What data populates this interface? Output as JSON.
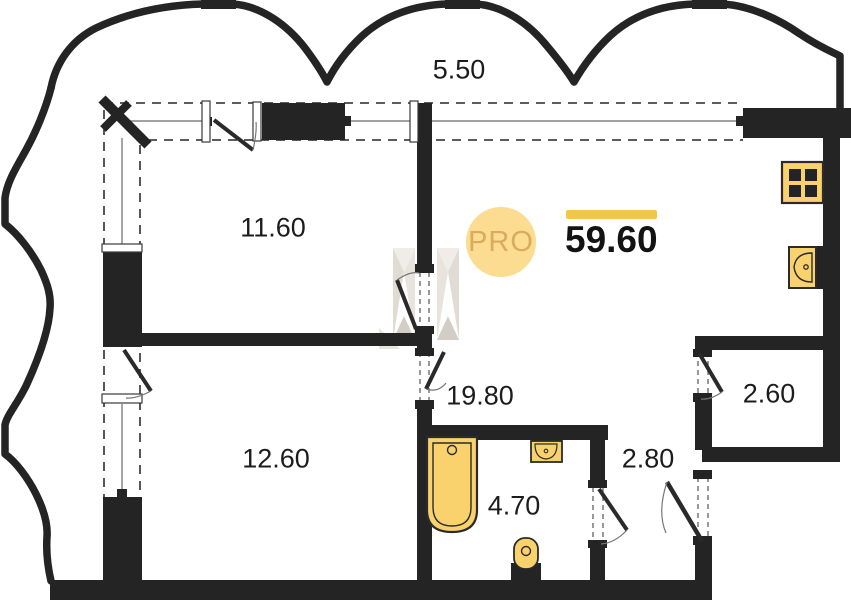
{
  "plan": {
    "type": "apartment-floor-plan",
    "badge": {
      "label": "PRO"
    },
    "total_area": {
      "value": "59.60"
    },
    "dimensions": {
      "top_width": "5.50"
    },
    "rooms": [
      {
        "id": "room-1",
        "area": "11.60"
      },
      {
        "id": "room-2",
        "area": "12.60"
      },
      {
        "id": "kitchen-living",
        "area": "19.80"
      },
      {
        "id": "bathroom",
        "area": "4.70"
      },
      {
        "id": "hallway",
        "area": "2.80"
      },
      {
        "id": "wardrobe",
        "area": "2.60"
      }
    ],
    "fixtures": [
      "stove-icon",
      "kitchen-sink-icon",
      "bathtub-icon",
      "bathroom-sink-icon",
      "toilet-icon"
    ],
    "colors": {
      "wall": "#242424",
      "accent_yellow": "#f2c64b",
      "fixture_fill": "#f9d26e",
      "badge_fill": "#fbdc90",
      "badge_text": "#d9ab5e",
      "watermark": "#e2ded6"
    }
  }
}
